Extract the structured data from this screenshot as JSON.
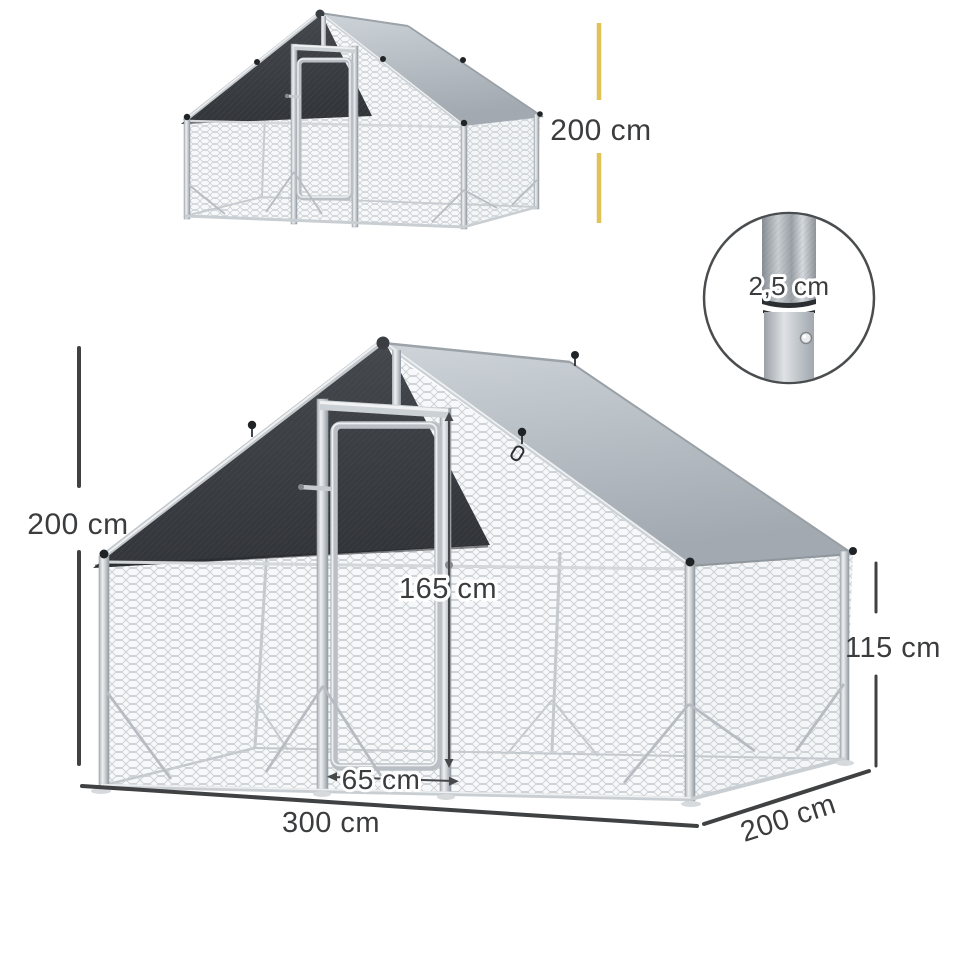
{
  "figure": {
    "type": "product-dimension-diagram",
    "subject": "walk-in metal chicken run cage with roof cover",
    "background": "#ffffff"
  },
  "labels": {
    "thumb_height": "200 cm",
    "tube_diameter": "2,5 cm",
    "main_height": "200 cm",
    "door_height": "165 cm",
    "side_height": "115 cm",
    "door_width": "65 cm",
    "width": "300 cm",
    "depth": "200 cm"
  },
  "colors": {
    "accent_yellow": "#e0c257",
    "dim_text": "#3a3c3e",
    "dim_line": "#3f4142",
    "tarp_dark": "#3c3f43",
    "roof_gray": "#b7bec4",
    "frame_silver": "#ccd1d5",
    "mesh_gray": "#c9ced3"
  }
}
